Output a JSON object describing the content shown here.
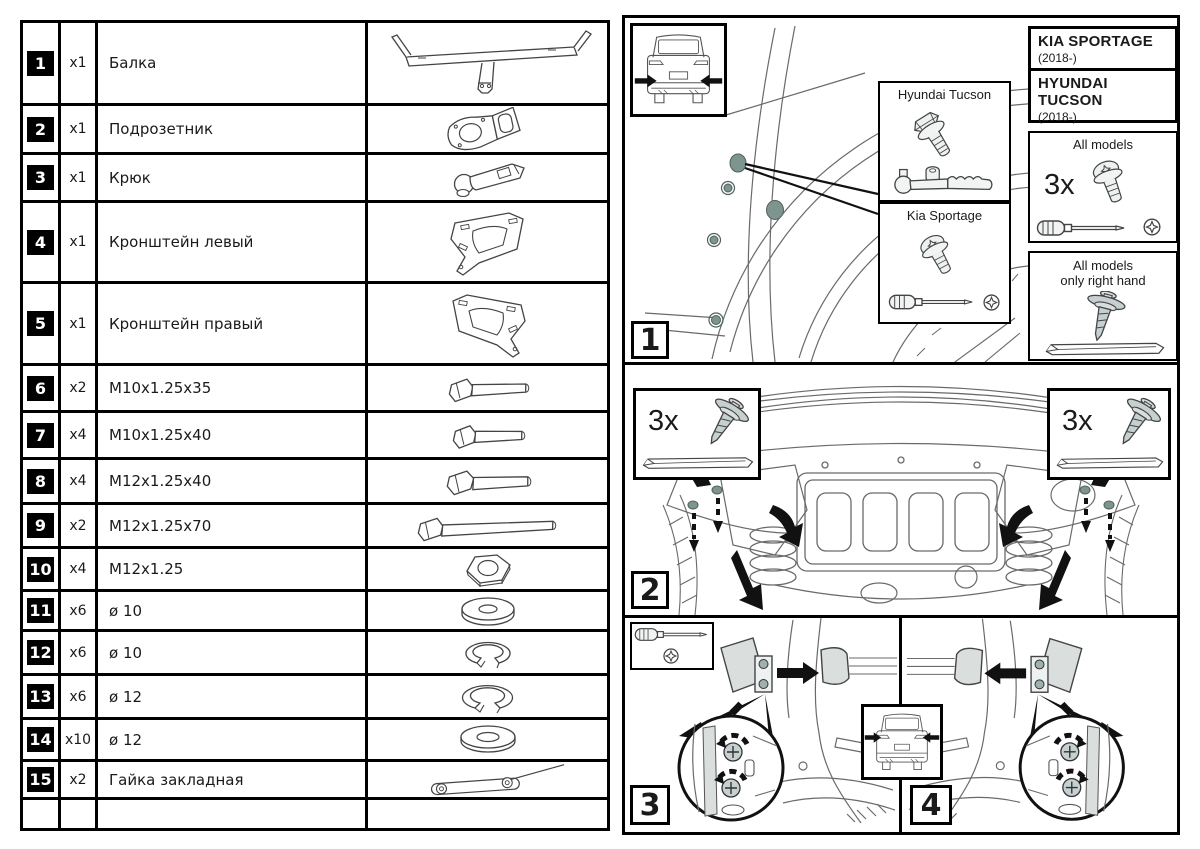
{
  "colors": {
    "accent_dot": "#7e948f",
    "part_gray": "#c6d0d0",
    "lamp_gray": "#dadedd",
    "line": "#4a4a4a",
    "black": "#000000"
  },
  "parts_table": {
    "rows": [
      {
        "num": "1",
        "qty": "x1",
        "name": "Балка",
        "icon": "beam"
      },
      {
        "num": "2",
        "qty": "x1",
        "name": "Подрозетник",
        "icon": "socket-plate"
      },
      {
        "num": "3",
        "qty": "x1",
        "name": "Крюк",
        "icon": "tow-hook"
      },
      {
        "num": "4",
        "qty": "x1",
        "name": "Кронштейн левый",
        "icon": "bracket-left"
      },
      {
        "num": "5",
        "qty": "x1",
        "name": "Кронштейн правый",
        "icon": "bracket-right"
      },
      {
        "num": "6",
        "qty": "x2",
        "name": "M10x1.25x35",
        "icon": "bolt"
      },
      {
        "num": "7",
        "qty": "x4",
        "name": "M10x1.25x40",
        "icon": "bolt"
      },
      {
        "num": "8",
        "qty": "x4",
        "name": "M12x1.25x40",
        "icon": "bolt"
      },
      {
        "num": "9",
        "qty": "x2",
        "name": "M12x1.25x70",
        "icon": "bolt-long"
      },
      {
        "num": "10",
        "qty": "x4",
        "name": "M12x1.25",
        "icon": "hex-nut"
      },
      {
        "num": "11",
        "qty": "x6",
        "name": "ø 10",
        "icon": "flat-washer"
      },
      {
        "num": "12",
        "qty": "x6",
        "name": "ø 10",
        "icon": "spring-washer"
      },
      {
        "num": "13",
        "qty": "x6",
        "name": "ø 12",
        "icon": "spring-washer"
      },
      {
        "num": "14",
        "qty": "x10",
        "name": "ø 12",
        "icon": "flat-washer"
      },
      {
        "num": "15",
        "qty": "x2",
        "name": "Гайка закладная",
        "icon": "weld-nut-strip"
      }
    ]
  },
  "steps": {
    "s1": "1",
    "s2": "2",
    "s3": "3",
    "s4": "4"
  },
  "step1": {
    "tucson_label": "Hyundai Tucson",
    "sportage_label": "Kia Sportage",
    "kia_title": "KIA SPORTAGE",
    "kia_sub": "(2018-)",
    "hyundai_title": "HYUNDAI TUCSON",
    "hyundai_sub": "(2018-)",
    "all_models": "All models",
    "all_models_qty": "3x",
    "right_hand_line1": "All models",
    "right_hand_line2": "only right hand"
  },
  "step2": {
    "left_qty": "3x",
    "right_qty": "3x"
  }
}
